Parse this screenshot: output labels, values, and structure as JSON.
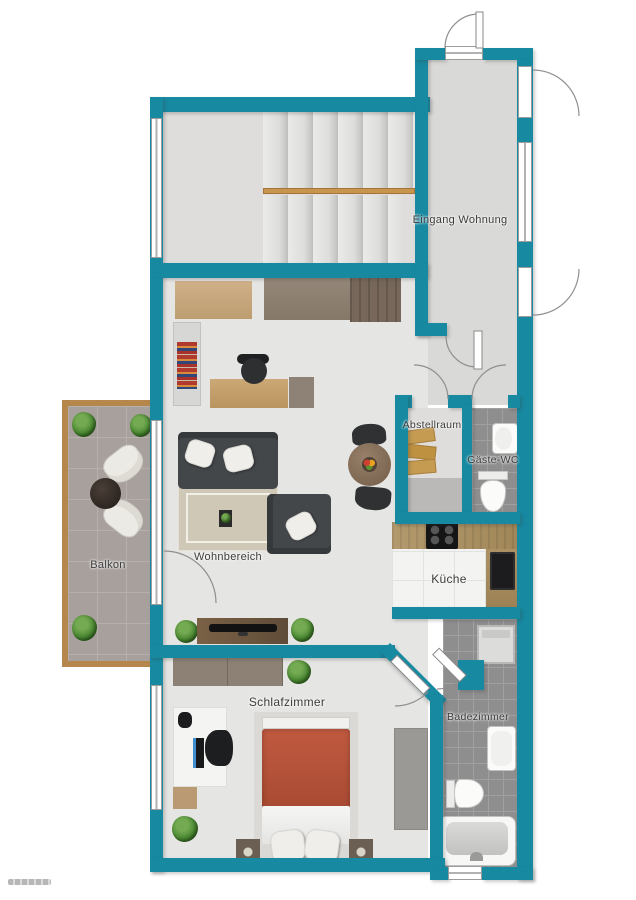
{
  "colors": {
    "wall": "#1789a1",
    "floor_light": "#e5e5e3",
    "floor_stair": "#dedddb",
    "tile_gray": "#8e8e8e",
    "balcony_trim": "#b5874d",
    "stair_rail": "#c8954f",
    "bed_duvet": "#b4533a"
  },
  "rooms": {
    "entrance": {
      "label": "Eingang Wohnung"
    },
    "storage": {
      "label": "Abstellraum"
    },
    "guest_wc": {
      "label": "Gäste-WC"
    },
    "living": {
      "label": "Wohnbereich"
    },
    "kitchen": {
      "label": "Küche"
    },
    "balcony": {
      "label": "Balkon"
    },
    "bedroom": {
      "label": "Schlafzimmer"
    },
    "bathroom": {
      "label": "Badezimmer"
    }
  }
}
